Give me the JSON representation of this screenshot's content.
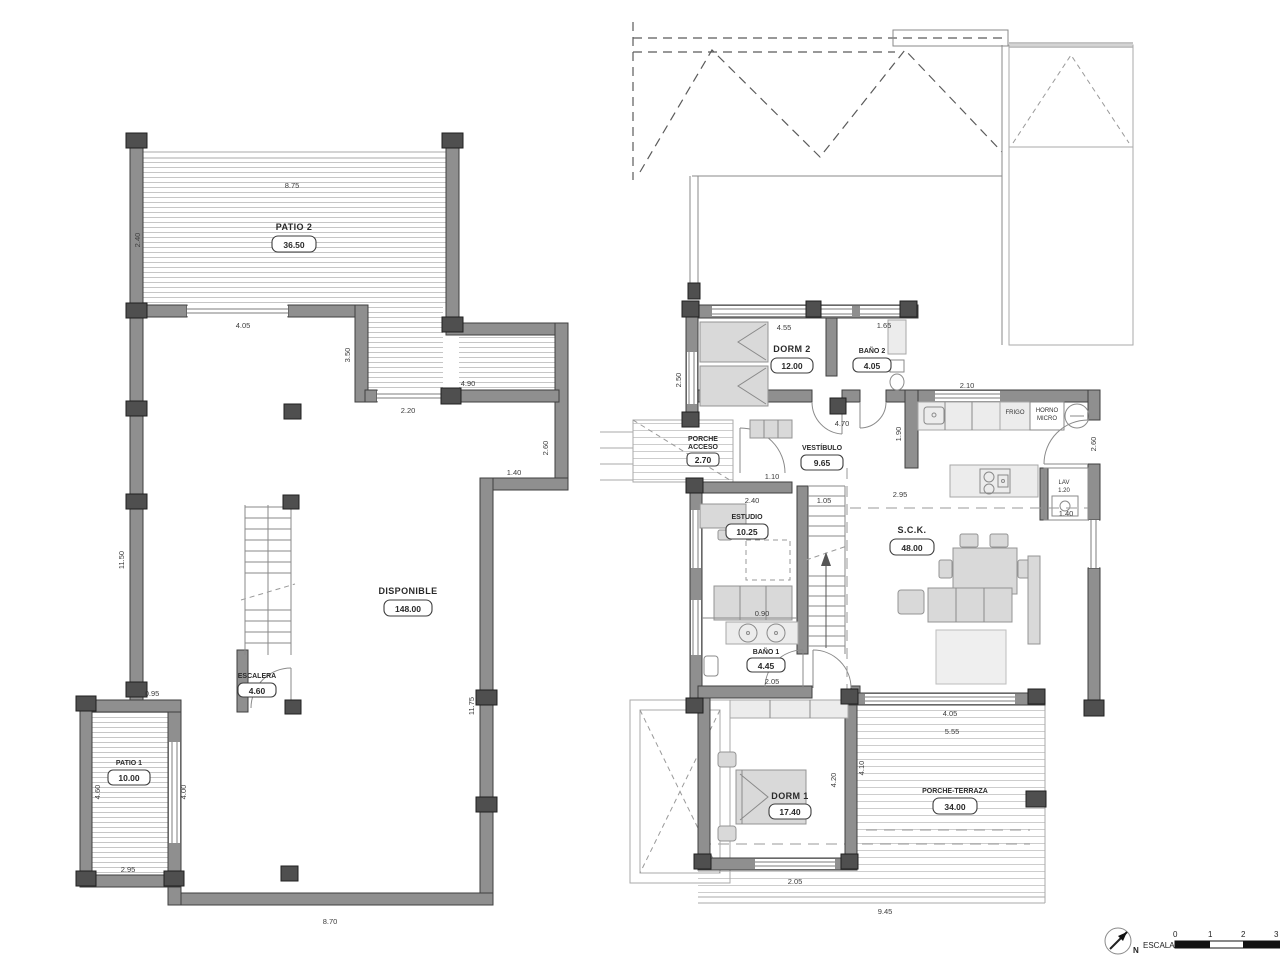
{
  "drawing": {
    "left_plan": {
      "rooms": {
        "patio2": {
          "name": "PATIO 2",
          "area": "36.50"
        },
        "disponible": {
          "name": "DISPONIBLE",
          "area": "148.00"
        },
        "escalera": {
          "name": "ESCALERA",
          "area": "4.60"
        },
        "patio1": {
          "name": "PATIO 1",
          "area": "10.00"
        }
      },
      "dims": {
        "top": "8.75",
        "left_top": "2.40",
        "top_window": "4.05",
        "inner_wall": "3.50",
        "upper_right": "4.90",
        "mid_window": "2.20",
        "right_upper": "2.60",
        "right_step": "1.40",
        "left_side": "11.50",
        "right_side": "11.75",
        "patio1_top": "0.95",
        "patio1_left": "4.60",
        "patio1_right": "4.00",
        "patio1_bottom": "2.95",
        "bottom": "8.70"
      }
    },
    "right_plan": {
      "rooms": {
        "dorm2": {
          "name": "DORM 2",
          "area": "12.00"
        },
        "bano2": {
          "name": "BAÑO 2",
          "area": "4.05"
        },
        "vestibulo": {
          "name": "VESTÍBULO",
          "area": "9.65"
        },
        "porche_acceso": {
          "line1": "PORCHE",
          "line2": "ACCESO",
          "area": "2.70"
        },
        "estudio": {
          "name": "ESTUDIO",
          "area": "10.25"
        },
        "sck": {
          "name": "S.C.K.",
          "area": "48.00"
        },
        "bano1": {
          "name": "BAÑO 1",
          "area": "4.45"
        },
        "dorm1": {
          "name": "DORM 1",
          "area": "17.40"
        },
        "porche_terraza": {
          "name": "PORCHE-TERRAZA",
          "area": "34.00"
        }
      },
      "fixtures": {
        "fridge": "FRIGO",
        "oven_line1": "HORNO",
        "oven_line2": "MICRO",
        "laundry": "LAV",
        "laundry_dim": "1.20"
      },
      "dims": {
        "dorm2_window": "4.55",
        "bano2_window": "1.65",
        "vestibulo_width": "4.70",
        "left_window": "2.50",
        "kitchen_window": "2.10",
        "kitchen_pass": "1.90",
        "entry_door": "2.60",
        "living_width": "2.95",
        "laundry_width": "1.40",
        "hall_a": "1.10",
        "hall_b": "2.40",
        "hall_c": "1.05",
        "sink_counter": "0.90",
        "closet": "2.05",
        "dorm1_height": "4.20",
        "terrace_left": "4.10",
        "dorm1_window": "2.05",
        "sck_bottom_a": "4.05",
        "sck_bottom_b": "5.55",
        "terrace_bottom": "9.45"
      }
    },
    "title_block": {
      "north": "N",
      "scale_label": "ESCALA :",
      "tick0": "0",
      "tick1": "1",
      "tick2": "2",
      "tick3": "3"
    }
  }
}
